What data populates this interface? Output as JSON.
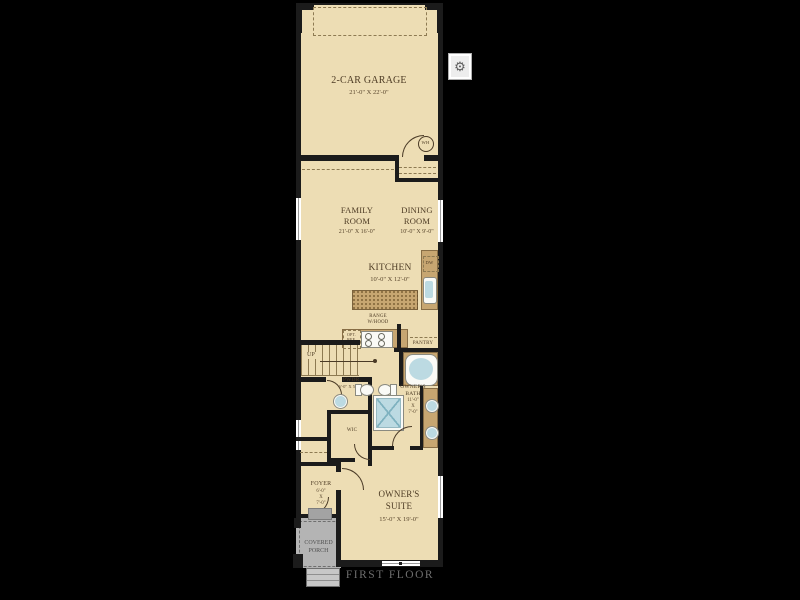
{
  "colors": {
    "background": "#000000",
    "floor": "#EDDDB4",
    "wall": "#1B1B1B",
    "cabinet_tan": "#C7A671",
    "fixture_blue": "#BCDAE2",
    "porch_gray": "#B4B4B4",
    "label_brown": "#4D3B24",
    "sheet_title_gray": "#6E6E6E"
  },
  "sheet": {
    "title": "FIRST FLOOR"
  },
  "controls": {
    "gear_glyph": "⚙"
  },
  "rooms": {
    "garage": {
      "name": "2-CAR GARAGE",
      "dims": "21'-0\" X 22'-0\""
    },
    "family": {
      "line1": "FAMILY",
      "line2": "ROOM",
      "dims": "21'-0\" X 16'-0\""
    },
    "dining": {
      "line1": "DINING",
      "line2": "ROOM",
      "dims": "10'-0\" X 9'-0\""
    },
    "kitchen": {
      "name": "KITCHEN",
      "dims": "10'-0\" X 12'-0\""
    },
    "owners_suite": {
      "line1": "OWNER'S",
      "line2": "SUITE",
      "dims": "15'-0\" X 19'-0\""
    },
    "owners_bath": {
      "line1": "OWNER'S",
      "line2": "BATH",
      "dim1": "11'-0\"",
      "dim2": "X",
      "dim3": "7'-0\""
    },
    "powder": {
      "name": "PWDR.",
      "dims": "6'-0\" X 5'-0\""
    },
    "foyer": {
      "name": "FOYER",
      "dim1": "6'-0\"",
      "dim2": "X",
      "dim3": "7'-0\""
    },
    "wic": {
      "name": "WIC"
    },
    "pantry": {
      "name": "PANTRY"
    },
    "porch": {
      "line1": "COVERED",
      "line2": "PORCH"
    }
  },
  "fixtures": {
    "range": {
      "line1": "RANGE",
      "line2": "W/HOOD"
    },
    "opt_ref": {
      "line1": "OPT.",
      "line2": "REF."
    },
    "dishwasher": "DW",
    "water_heater": "WH",
    "stairs_up": "UP"
  }
}
